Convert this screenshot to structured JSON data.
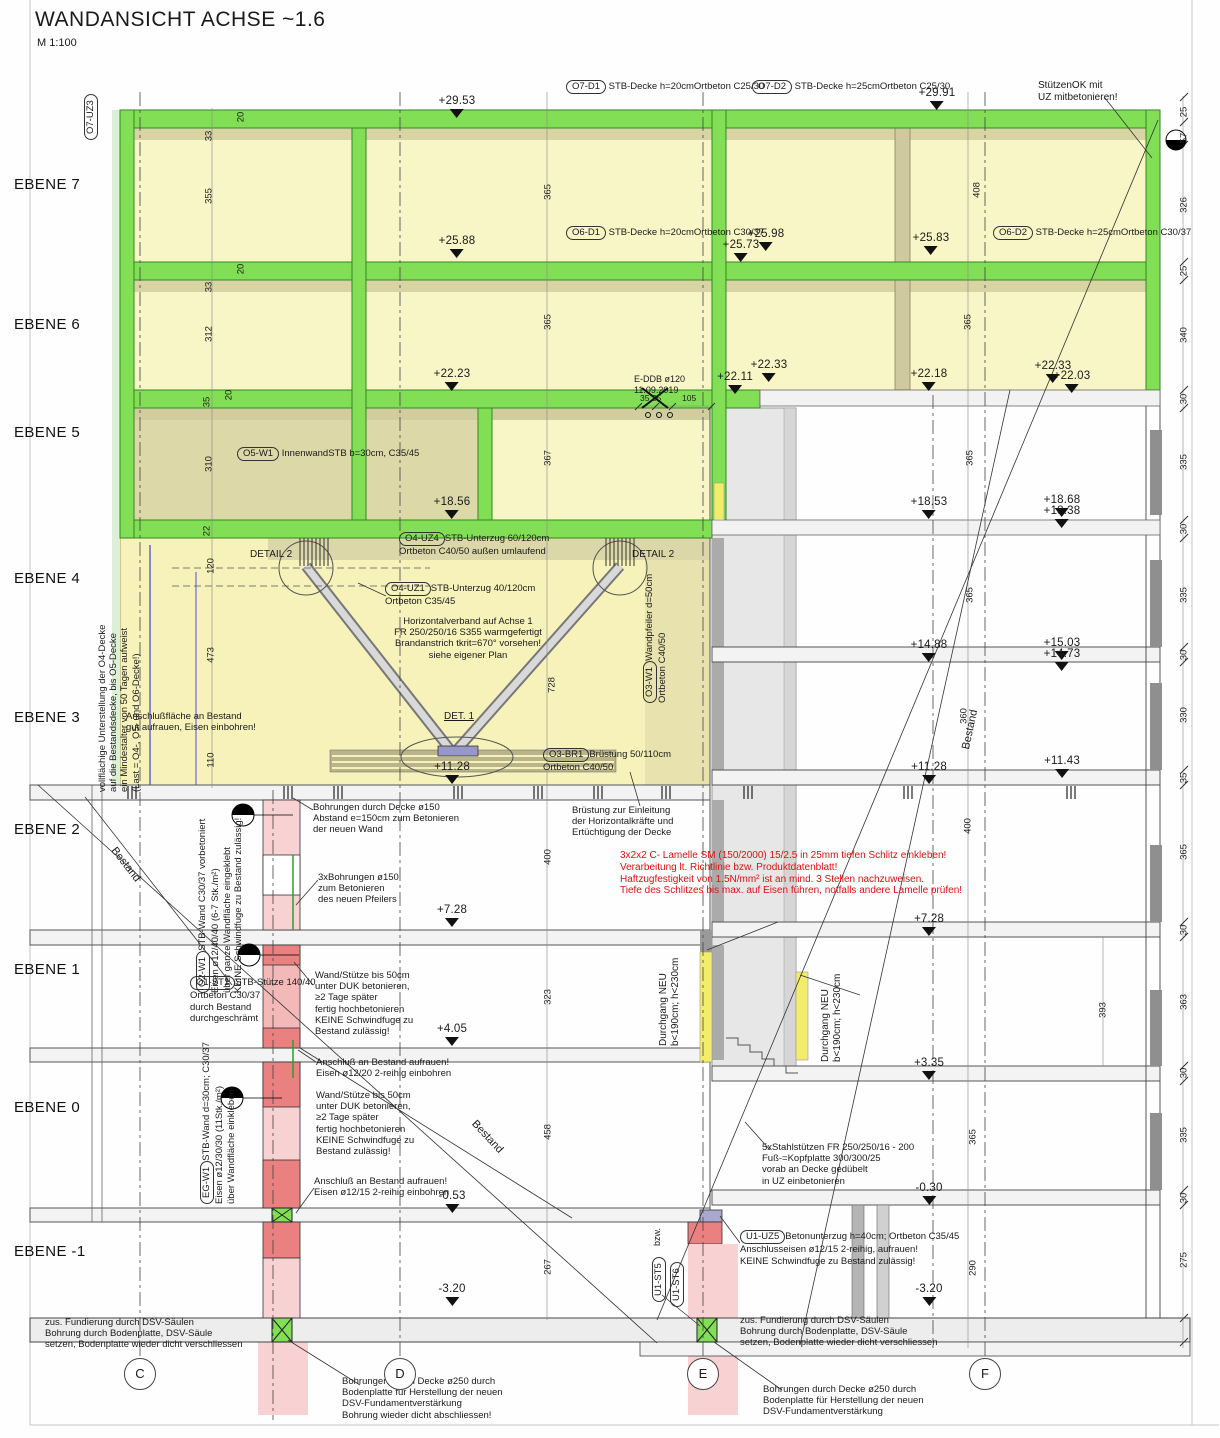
{
  "title": {
    "text": "WANDANSICHT ACHSE ~1.6",
    "scale": "M 1:100"
  },
  "colors": {
    "slab_green": "#82df55",
    "band_olive": "#d9d4a4",
    "room_yellow": "#f8f5c6",
    "room_dark": "#ddd8a8",
    "new_pink": "#f8d2d2",
    "new_red": "#ea8080",
    "door_yellow": "#f2ec6a",
    "note_red": "#e01010",
    "existing_gray": "#e7e7e7"
  },
  "ebenen": [
    {
      "label": "EBENE 7",
      "y": 176
    },
    {
      "label": "EBENE 6",
      "y": 316
    },
    {
      "label": "EBENE 5",
      "y": 424
    },
    {
      "label": "EBENE 4",
      "y": 570
    },
    {
      "label": "EBENE 3",
      "y": 709
    },
    {
      "label": "EBENE 2",
      "y": 821
    },
    {
      "label": "EBENE 1",
      "y": 961
    },
    {
      "label": "EBENE 0",
      "y": 1099
    },
    {
      "label": "EBENE -1",
      "y": 1243
    }
  ],
  "axes": [
    {
      "label": "C",
      "x": 140
    },
    {
      "label": "D",
      "x": 400
    },
    {
      "label": "E",
      "x": 703
    },
    {
      "label": "F",
      "x": 985
    }
  ],
  "callouts": [
    {
      "label": "O7-UZ3",
      "x": 84,
      "y": 140,
      "r": -90
    },
    {
      "label": "O7-D1",
      "x": 566,
      "y": 80,
      "mode": "inline",
      "desc": "STB-Decke h=20cm\nOrtbeton C25/30"
    },
    {
      "label": "O7-D2",
      "x": 752,
      "y": 80,
      "mode": "inline",
      "desc": "STB-Decke h=25cm\nOrtbeton C25/30"
    },
    {
      "label": "O6-D1",
      "x": 566,
      "y": 226,
      "mode": "inline",
      "desc": "STB-Decke h=20cm\nOrtbeton C30/37"
    },
    {
      "label": "O6-D2",
      "x": 993,
      "y": 226,
      "mode": "inline",
      "desc": "STB-Decke h=25cm\nOrtbeton C30/37"
    },
    {
      "label": "O5-W1",
      "x": 237,
      "y": 447,
      "mode": "inline",
      "desc": "Innenwand\nSTB b=30cm, C35/45"
    },
    {
      "label": "O4-UZ4",
      "x": 399,
      "y": 532,
      "mode": "stack",
      "desc": "STB-Unterzug 60/120cm\nOrtbeton C40/50 außen umlaufend"
    },
    {
      "label": "O4-UZ1",
      "x": 385,
      "y": 582,
      "mode": "stack",
      "desc": "STB-Unterzug 40/120cm\nOrtbeton C35/45"
    },
    {
      "label": "O3-W1",
      "x": 643,
      "y": 703,
      "r": -90,
      "mode": "stack",
      "desc": "Wandpfeiler d=50cm\nOrtbeton C40/50"
    },
    {
      "label": "O3-BR1",
      "x": 543,
      "y": 748,
      "mode": "stack",
      "desc": "Brüstung 50/110cm\nOrtbeton C40/50"
    },
    {
      "label": "O2-W1",
      "x": 196,
      "y": 993,
      "r": -90,
      "mode": "stack",
      "desc": "STB-Wand C30/37 vorbetoniert\nEisen ø12/40/40 (6-7 Stk./m²)\nüber ganze Wandfläche eingeklebt\nKEINE Schwindfuge zu Bestand zulässig!"
    },
    {
      "label": "O1-ST1",
      "x": 190,
      "y": 976,
      "mode": "stack",
      "desc": "STB-Stütze 140/40\nOrtbeton C30/37\ndurch Bestand\ndurchgeschrämt"
    },
    {
      "label": "EG-W1",
      "x": 200,
      "y": 1204,
      "r": -90,
      "mode": "stack",
      "desc": "STB-Wand d=30cm; C30/37\nEisen ø12/30/30 (11Stk./m²)\nüber Wandfläche einkleben!"
    },
    {
      "label": "U1-UZ5",
      "x": 740,
      "y": 1230,
      "mode": "stack",
      "desc": "Betonunterzug h=40cm; Ortbeton C35/45\nAnschlusseisen ø12/15 2-reihig, aufrauen!\nKEINE Schwindfuge zu Bestand zulässig!"
    },
    {
      "label": "U1-ST5",
      "x": 652,
      "y": 1302,
      "r": -90
    },
    {
      "label": "U1-ST6",
      "x": 670,
      "y": 1307,
      "r": -90
    }
  ],
  "annotations": [
    {
      "n": "note-stuetzenok",
      "t": "StützenOK mit\nUZ mitbetonieren!",
      "x": 1038,
      "y": 80,
      "s": 10
    },
    {
      "n": "note-e-ddb",
      "t": "E-DDB ø120\n11.09.2019",
      "x": 634,
      "y": 374,
      "s": 9
    },
    {
      "n": "label-detail2-left",
      "t": "DETAIL 2",
      "x": 250,
      "y": 549,
      "s": 10
    },
    {
      "n": "label-detail2-right",
      "t": "DETAIL 2",
      "x": 632,
      "y": 549,
      "s": 10
    },
    {
      "n": "note-horizontalverband",
      "t": "Horizontalverband auf Achse 1\nFR 250/250/16 S355 warmgefertigt\nBrandanstrich tkrit=670° vorsehen!\nsiehe eigener Plan",
      "x": 368,
      "y": 616,
      "s": 9.5,
      "a": "center",
      "w": 200
    },
    {
      "n": "label-det1",
      "t": "DET. 1",
      "x": 444,
      "y": 711,
      "s": 10,
      "cls": "ul"
    },
    {
      "n": "note-anschlussflaeche",
      "t": "Anschlußfläche an Bestand\ngut aufrauen, Eisen einbohren!",
      "x": 126,
      "y": 711,
      "s": 9.5
    },
    {
      "n": "note-bohrungen150",
      "t": "Bohrungen durch Decke ø150\nAbstand e=150cm zum Betonieren\nder neuen Wand",
      "x": 313,
      "y": 802,
      "s": 9.5
    },
    {
      "n": "note-bruestung",
      "t": "Brüstung zur Einleitung\nder Horizontalkräfte und\nErtüchtigung der Decke",
      "x": 572,
      "y": 805,
      "s": 9.5
    },
    {
      "n": "note-lamelle",
      "t": "3x2x2 C- Lamelle SM (150/2000) 15/2.5 in 25mm tiefen Schlitz einkleben!\nVerarbeitung lt. Richtlinie bzw. Produktdatenblatt!\nHaftzugfestigkeit von 1.5N/mm² ist an mind. 3 Stellen nachzuweisen.\nTiefe des Schlitzes bis max. auf Eisen führen, notfalls andere Lamelle prüfen!",
      "x": 620,
      "y": 850,
      "s": 10,
      "c": "#e01010"
    },
    {
      "n": "note-3xbohrungen",
      "t": "3xBohrungen ø150\nzum Betonieren\ndes neuen Pfeilers",
      "x": 318,
      "y": 872,
      "s": 9.5
    },
    {
      "n": "note-wandstuetze-1",
      "t": "Wand/Stütze bis 50cm\nunter DUK betonieren,\n≥2 Tage später\nfertig hochbetonieren\nKEINE Schwindfuge zu\nBestand zulässig!",
      "x": 315,
      "y": 970,
      "s": 9.5
    },
    {
      "n": "note-anschluss-12-20",
      "t": "Anschluß an Bestand aufrauen!\nEisen ø12/20 2-reihig einbohren",
      "x": 316,
      "y": 1057,
      "s": 9.5
    },
    {
      "n": "note-wandstuetze-2",
      "t": "Wand/Stütze bis 50cm\nunter DUK betonieren,\n≥2 Tage später\nfertig hochbetonieren\nKEINE Schwindfuge zu\nBestand zulässig!",
      "x": 316,
      "y": 1090,
      "s": 9.5
    },
    {
      "n": "note-anschluss-12-15",
      "t": "Anschluß an Bestand aufrauen!\nEisen ø12/15 2-reihig einbohren",
      "x": 314,
      "y": 1176,
      "s": 9.5
    },
    {
      "n": "note-stahlstuetzen",
      "t": "5xStahlstützen FR 250/250/16 - 200\nFuß-=Kopfplatte 300/300/25\nvorab an Decke gedübelt\nin UZ einbetonieren",
      "x": 762,
      "y": 1142,
      "s": 9.5
    },
    {
      "n": "note-fundierung-links",
      "t": "zus. Fundierung durch DSV-Säulen\nBohrung durch Bodenplatte, DSV-Säule\nsetzen, Bodenplatte wieder dicht verschliessen",
      "x": 45,
      "y": 1317,
      "s": 9.5
    },
    {
      "n": "note-fundierung-rechts",
      "t": "zus. Fundierung durch DSV-Säulen\nBohrung durch Bodenplatte, DSV-Säule\nsetzen, Bodenplatte wieder dicht verschliessen",
      "x": 740,
      "y": 1315,
      "s": 9.5
    },
    {
      "n": "note-bohrungen250-links",
      "t": "Bohrungen durch Decke ø250 durch\nBodenplatte für Herstellung der neuen\nDSV-Fundamentverstärkung\nBohrung wieder dicht abschliessen!",
      "x": 342,
      "y": 1376,
      "s": 9.5
    },
    {
      "n": "note-bohrungen250-rechts",
      "t": "Bohrungen durch Decke ø250 durch\nBodenplatte für Herstellung der neuen\nDSV-Fundamentverstärkung",
      "x": 763,
      "y": 1384,
      "s": 9.5
    },
    {
      "n": "note-unterstellung",
      "t": "vollflächige Unterstellung der O4-Decke\nauf die Bestandsdecke, bis O5-Decke\nein Mindestalter von 50 Tagen aufweist\n(Last = O4-, O5- und O6-Decke!)",
      "x": 97,
      "y": 792,
      "s": 9.5,
      "r": -90
    },
    {
      "n": "label-durchgang-1",
      "t": "Durchgang NEU\nb<190cm; h<230cm",
      "x": 658,
      "y": 1046,
      "s": 10,
      "r": -90
    },
    {
      "n": "label-durchgang-2",
      "t": "Durchgang NEU\nb<190cm; h<230cm",
      "x": 820,
      "y": 1062,
      "s": 10,
      "r": -90
    },
    {
      "n": "label-bestand-links",
      "t": "Bestand",
      "x": 118,
      "y": 845,
      "s": 11,
      "r": 52
    },
    {
      "n": "label-bestand-mitte",
      "t": "Bestand",
      "x": 478,
      "y": 1118,
      "s": 11,
      "r": 47
    },
    {
      "n": "label-bestand-rechts",
      "t": "Bestand",
      "x": 960,
      "y": 748,
      "s": 11,
      "r": -78
    },
    {
      "n": "dim-35-35",
      "t": "35 35",
      "x": 640,
      "y": 393,
      "s": 8.5
    },
    {
      "n": "dim-105",
      "t": "105",
      "x": 682,
      "y": 393,
      "s": 8.5
    },
    {
      "n": "label-bzw",
      "t": "bzw.",
      "x": 652,
      "y": 1246,
      "s": 9,
      "r": -90
    }
  ],
  "elevations": [
    {
      "v": "+29.53",
      "x": 457,
      "y": 96
    },
    {
      "v": "+29.91",
      "x": 937,
      "y": 88
    },
    {
      "v": "+25.88",
      "x": 457,
      "y": 236
    },
    {
      "v": "+25.98",
      "x": 766,
      "y": 229
    },
    {
      "v": "+25.73",
      "x": 741,
      "y": 240
    },
    {
      "v": "+25.83",
      "x": 931,
      "y": 233
    },
    {
      "v": "+22.23",
      "x": 452,
      "y": 369
    },
    {
      "v": "+22.33",
      "x": 769,
      "y": 360
    },
    {
      "v": "+22.11",
      "x": 735,
      "y": 372
    },
    {
      "v": "+22.18",
      "x": 929,
      "y": 369
    },
    {
      "v": "+22.33",
      "x": 1053,
      "y": 361
    },
    {
      "v": "+22.03",
      "x": 1072,
      "y": 371
    },
    {
      "v": "+18.56",
      "x": 452,
      "y": 497
    },
    {
      "v": "+18.53",
      "x": 929,
      "y": 497
    },
    {
      "v": "+18.68",
      "x": 1062,
      "y": 495
    },
    {
      "v": "+18.38",
      "x": 1062,
      "y": 506
    },
    {
      "v": "+14.88",
      "x": 929,
      "y": 640
    },
    {
      "v": "+15.03",
      "x": 1062,
      "y": 638
    },
    {
      "v": "+14.73",
      "x": 1062,
      "y": 649
    },
    {
      "v": "+11.28",
      "x": 452,
      "y": 762
    },
    {
      "v": "+11.28",
      "x": 929,
      "y": 762
    },
    {
      "v": "+11.43",
      "x": 1062,
      "y": 756
    },
    {
      "v": "+7.28",
      "x": 452,
      "y": 905
    },
    {
      "v": "+7.28",
      "x": 929,
      "y": 914
    },
    {
      "v": "+4.05",
      "x": 452,
      "y": 1024
    },
    {
      "v": "+3.35",
      "x": 929,
      "y": 1058
    },
    {
      "v": "-0.53",
      "x": 452,
      "y": 1191
    },
    {
      "v": "-0.30",
      "x": 929,
      "y": 1183
    },
    {
      "v": "-3.20",
      "x": 452,
      "y": 1284
    },
    {
      "v": "-3.20",
      "x": 929,
      "y": 1284
    }
  ],
  "dimensions": [
    {
      "v": "25",
      "x": 1184,
      "y": 112
    },
    {
      "v": "57",
      "x": 1184,
      "y": 138
    },
    {
      "v": "326",
      "x": 1184,
      "y": 205
    },
    {
      "v": "25",
      "x": 1184,
      "y": 271
    },
    {
      "v": "340",
      "x": 1184,
      "y": 335
    },
    {
      "v": "30",
      "x": 1184,
      "y": 399
    },
    {
      "v": "335",
      "x": 1184,
      "y": 462
    },
    {
      "v": "30",
      "x": 1184,
      "y": 529
    },
    {
      "v": "335",
      "x": 1184,
      "y": 595
    },
    {
      "v": "30",
      "x": 1184,
      "y": 655
    },
    {
      "v": "330",
      "x": 1184,
      "y": 715
    },
    {
      "v": "35",
      "x": 1184,
      "y": 778
    },
    {
      "v": "365",
      "x": 1184,
      "y": 852
    },
    {
      "v": "30",
      "x": 1184,
      "y": 930
    },
    {
      "v": "363",
      "x": 1184,
      "y": 1002
    },
    {
      "v": "30",
      "x": 1184,
      "y": 1073
    },
    {
      "v": "335",
      "x": 1184,
      "y": 1135
    },
    {
      "v": "30",
      "x": 1184,
      "y": 1198
    },
    {
      "v": "275",
      "x": 1184,
      "y": 1260
    },
    {
      "v": "33",
      "x": 209,
      "y": 136
    },
    {
      "v": "355",
      "x": 209,
      "y": 196
    },
    {
      "v": "33",
      "x": 209,
      "y": 287
    },
    {
      "v": "312",
      "x": 209,
      "y": 334
    },
    {
      "v": "35",
      "x": 207,
      "y": 402
    },
    {
      "v": "310",
      "x": 209,
      "y": 464
    },
    {
      "v": "22",
      "x": 207,
      "y": 531
    },
    {
      "v": "120",
      "x": 211,
      "y": 566
    },
    {
      "v": "473",
      "x": 211,
      "y": 655
    },
    {
      "v": "110",
      "x": 211,
      "y": 760
    },
    {
      "v": "20",
      "x": 241,
      "y": 117
    },
    {
      "v": "20",
      "x": 241,
      "y": 269
    },
    {
      "v": "20",
      "x": 229,
      "y": 395
    },
    {
      "v": "365",
      "x": 548,
      "y": 192
    },
    {
      "v": "365",
      "x": 548,
      "y": 322
    },
    {
      "v": "367",
      "x": 548,
      "y": 458
    },
    {
      "v": "728",
      "x": 552,
      "y": 685
    },
    {
      "v": "400",
      "x": 548,
      "y": 857
    },
    {
      "v": "323",
      "x": 548,
      "y": 997
    },
    {
      "v": "458",
      "x": 548,
      "y": 1132
    },
    {
      "v": "267",
      "x": 548,
      "y": 1267
    },
    {
      "v": "408",
      "x": 977,
      "y": 190
    },
    {
      "v": "365",
      "x": 968,
      "y": 322
    },
    {
      "v": "365",
      "x": 970,
      "y": 458
    },
    {
      "v": "365",
      "x": 970,
      "y": 595
    },
    {
      "v": "360",
      "x": 964,
      "y": 716
    },
    {
      "v": "400",
      "x": 968,
      "y": 826
    },
    {
      "v": "393",
      "x": 1103,
      "y": 1010
    },
    {
      "v": "365",
      "x": 973,
      "y": 1137
    },
    {
      "v": "290",
      "x": 973,
      "y": 1268
    }
  ]
}
